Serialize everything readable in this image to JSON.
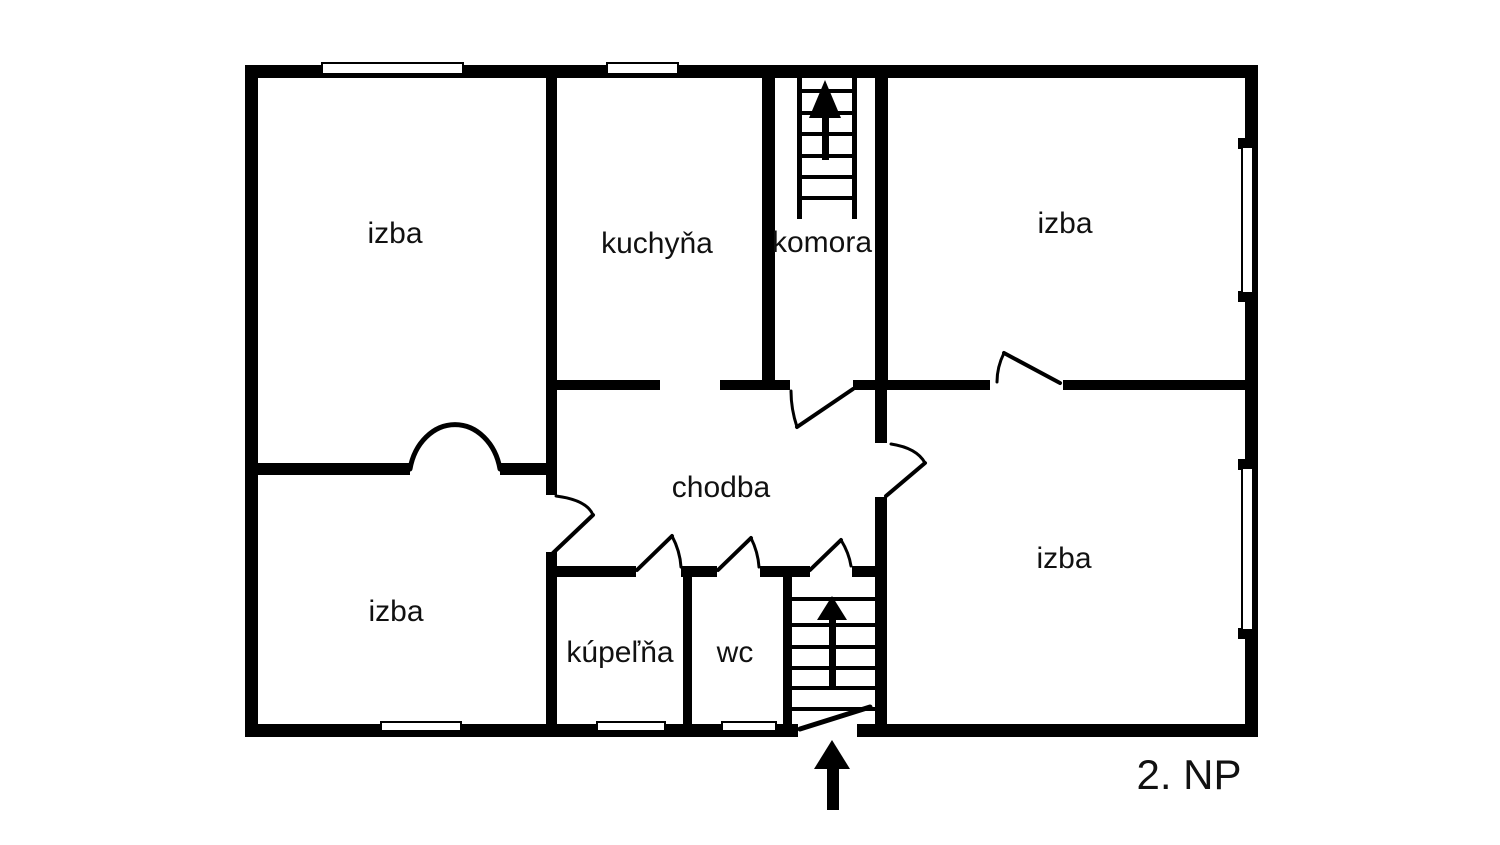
{
  "floor_plan": {
    "title": "2. NP",
    "rooms": {
      "top_left_room": {
        "label": "izba"
      },
      "kitchen": {
        "label": "kuchyňa"
      },
      "pantry": {
        "label": "komora"
      },
      "top_right_room": {
        "label": "izba"
      },
      "hallway": {
        "label": "chodba"
      },
      "bottom_left_room": {
        "label": "izba"
      },
      "bathroom": {
        "label": "kúpeľňa"
      },
      "toilet": {
        "label": "wc"
      },
      "bottom_right_room": {
        "label": "izba"
      }
    },
    "colors": {
      "walls": "#000000",
      "background": "#ffffff",
      "text": "#111111"
    }
  }
}
